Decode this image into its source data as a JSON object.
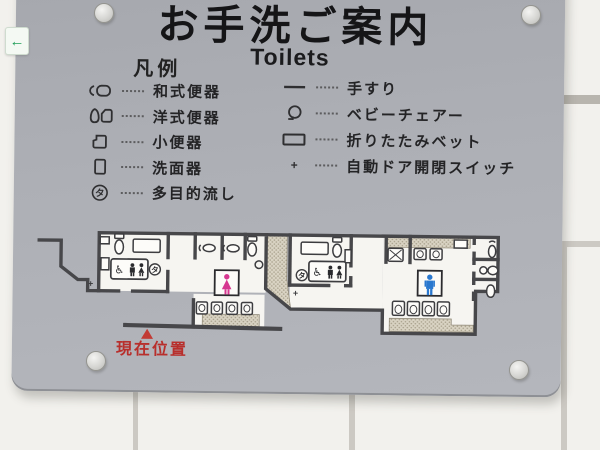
{
  "sign": {
    "title": "お手洗ご案内",
    "subtitle": "Toilets",
    "legend": {
      "header": "凡例",
      "left_items": [
        {
          "icon": "squat-toilet-icon",
          "label": "和式便器"
        },
        {
          "icon": "western-toilet-icon",
          "label": "洋式便器"
        },
        {
          "icon": "urinal-icon",
          "label": "小便器"
        },
        {
          "icon": "washbasin-icon",
          "label": "洗面器"
        },
        {
          "icon": "multipurpose-sink-icon",
          "label": "多目的流し"
        }
      ],
      "right_items": [
        {
          "icon": "handrail-icon",
          "label": "手すり"
        },
        {
          "icon": "baby-chair-icon",
          "label": "ベビーチェアー"
        },
        {
          "icon": "folding-bed-icon",
          "label": "折りたたみベット"
        },
        {
          "icon": "auto-door-switch-icon",
          "label": "自動ドア開閉スイッチ"
        }
      ]
    },
    "symbols": {
      "multipurpose_sink": "タ",
      "door_switch": "+",
      "wheelchair": "♿",
      "exit_arrow": "←"
    },
    "map": {
      "current_location_label": "現在位置"
    },
    "colors": {
      "sign_background": "#adafb5",
      "wall_tile": "#f2f1ed",
      "plan_wall": "#47474a",
      "hatch_fill": "#d9d3c3",
      "female_pictogram": "#d63790",
      "male_pictogram": "#2a78cf",
      "current_location_red": "#b82f2c",
      "exit_arrow_green": "#1f9e57"
    }
  }
}
